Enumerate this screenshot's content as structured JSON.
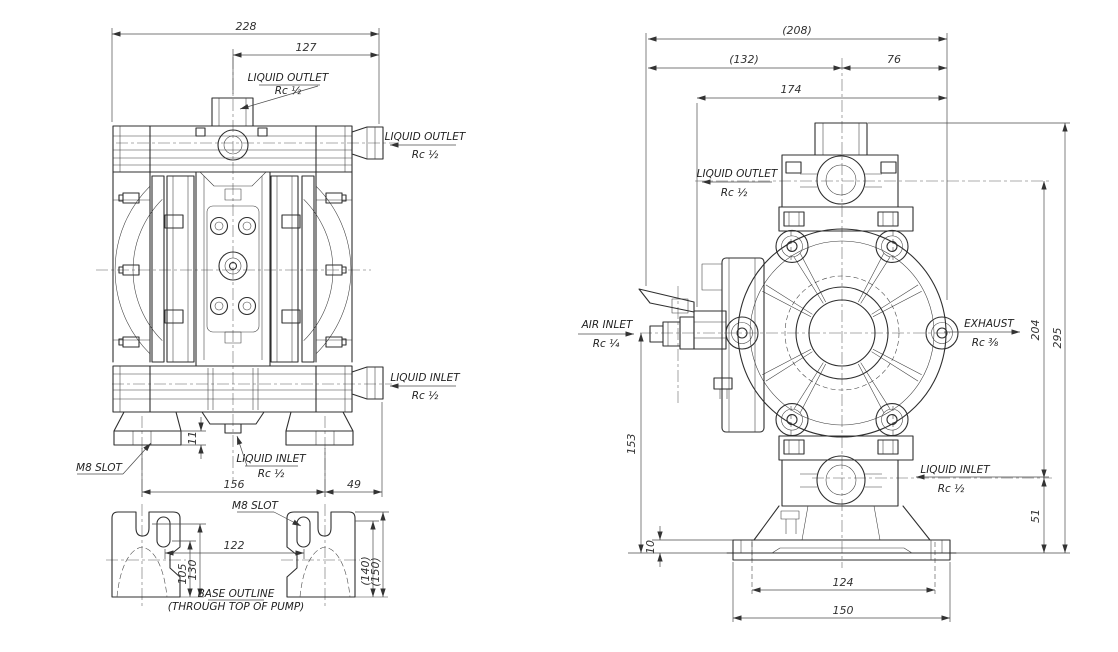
{
  "labels": {
    "liquid_outlet": "LIQUID OUTLET",
    "liquid_inlet": "LIQUID INLET",
    "air_inlet": "AIR INLET",
    "exhaust": "EXHAUST",
    "rc12": "Rc ½",
    "rc14": "Rc ¼",
    "rc38": "Rc ⅜",
    "m8_slot": "M8 SLOT",
    "base_outline": "BASE OUTLINE",
    "base_outline_sub": "(THROUGH TOP OF PUMP)"
  },
  "dims": {
    "front": {
      "total_width": "228",
      "outlet_offset": "127",
      "foot_span": "156",
      "foot_to_inlet": "49",
      "foot_height": "11"
    },
    "base": {
      "slot_span": "122",
      "h105": "105",
      "h130": "130",
      "h140": "(140)",
      "h150": "(150)"
    },
    "side": {
      "w208": "(208)",
      "w132": "(132)",
      "w76": "76",
      "w174": "174",
      "v295": "295",
      "v204": "204",
      "v153": "153",
      "v51": "51",
      "v10": "10",
      "w124": "124",
      "w150": "150"
    }
  },
  "colors": {
    "line": "#2f2f2f",
    "dimension": "#4b4b4b",
    "background": "#ffffff"
  }
}
